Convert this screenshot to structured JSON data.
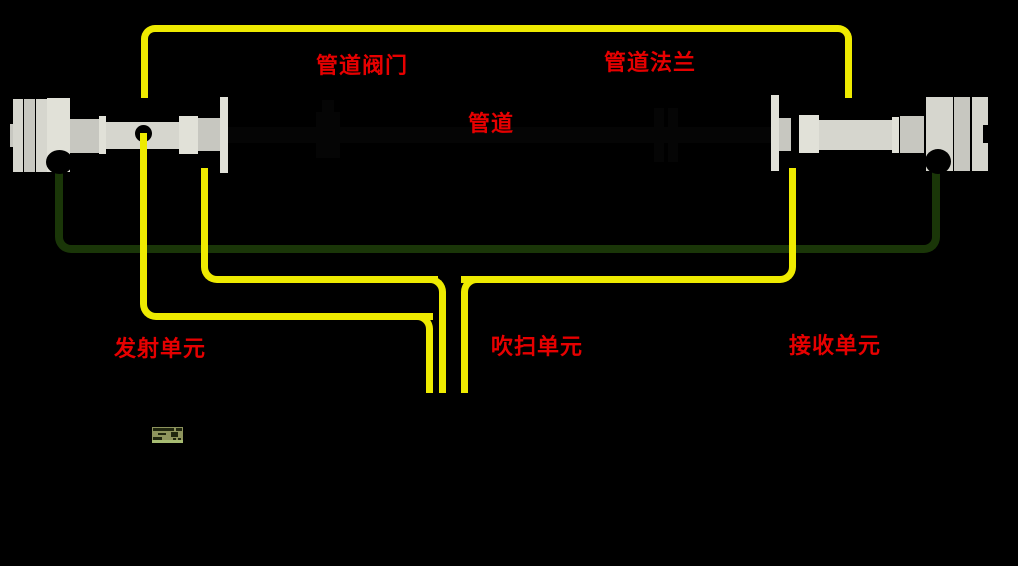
{
  "canvas": {
    "width": 1018,
    "height": 566,
    "background": "#000000"
  },
  "labels": {
    "pipe_valve": "管道阀门",
    "pipe_flange": "管道法兰",
    "pipe": "管道",
    "transmitter_unit": "发射单元",
    "purge_unit": "吹扫单元",
    "receiver_unit": "接收单元"
  },
  "colors": {
    "background": "#000000",
    "label_red": "#e60000",
    "tube_yellow": "#eeea00",
    "cable_green": "#1a3608",
    "device_gray": "#d6d6ce",
    "lcd_bg": "#8e945d",
    "lcd_strip": "#a7bc72"
  }
}
